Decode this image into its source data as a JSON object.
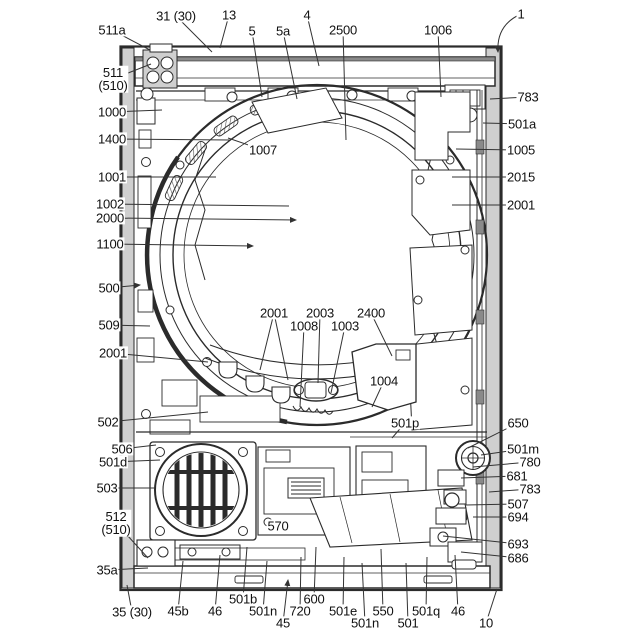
{
  "figure": {
    "kind": "patent-line-drawing",
    "colors": {
      "background": "#ffffff",
      "line": "#2b2b2b",
      "label_text": "#111111",
      "edge_gray": "#cfcfcf"
    },
    "labels": [
      {
        "t": "511a",
        "x": 112,
        "y": 30,
        "to": [
          [
            150,
            50
          ]
        ]
      },
      {
        "t": "31 (30)",
        "x": 176,
        "y": 16,
        "to": [
          [
            212,
            52
          ]
        ]
      },
      {
        "t": "13",
        "x": 229,
        "y": 15,
        "to": [
          [
            220,
            48
          ]
        ]
      },
      {
        "t": "5",
        "x": 252,
        "y": 31,
        "to": [
          [
            262,
            97
          ]
        ]
      },
      {
        "t": "5a",
        "x": 283,
        "y": 31,
        "to": [
          [
            297,
            99
          ]
        ]
      },
      {
        "t": "4",
        "x": 307,
        "y": 15,
        "to": [
          [
            319,
            66
          ]
        ]
      },
      {
        "t": "2500",
        "x": 343,
        "y": 30,
        "to": [
          [
            346,
            140
          ]
        ]
      },
      {
        "t": "1006",
        "x": 438,
        "y": 30,
        "to": [
          [
            441,
            97
          ]
        ]
      },
      {
        "t": "1",
        "x": 521,
        "y": 14,
        "to": [
          [
            498,
            52
          ]
        ],
        "arrow": true,
        "curve": true
      },
      {
        "t": "511\n(510)",
        "x": 113,
        "y": 79,
        "to": [
          [
            151,
            64
          ]
        ]
      },
      {
        "t": "1000",
        "x": 112,
        "y": 112,
        "to": [
          [
            162,
            110
          ]
        ]
      },
      {
        "t": "1400",
        "x": 112,
        "y": 139,
        "to": [
          [
            230,
            140
          ]
        ]
      },
      {
        "t": "1001",
        "x": 112,
        "y": 177,
        "to": [
          [
            216,
            177
          ]
        ]
      },
      {
        "t": "1002",
        "x": 110,
        "y": 204,
        "to": [
          [
            289,
            206
          ]
        ]
      },
      {
        "t": "2000",
        "x": 110,
        "y": 218,
        "to": [
          [
            296,
            220
          ]
        ],
        "arrow": true
      },
      {
        "t": "1100",
        "x": 110,
        "y": 244,
        "to": [
          [
            253,
            246
          ]
        ],
        "arrow": true
      },
      {
        "t": "500",
        "x": 109,
        "y": 288,
        "to": [
          [
            140,
            285
          ]
        ],
        "arrow": true
      },
      {
        "t": "509",
        "x": 109,
        "y": 325,
        "to": [
          [
            150,
            326
          ]
        ]
      },
      {
        "t": "2001",
        "x": 113,
        "y": 353,
        "to": [
          [
            208,
            362
          ]
        ]
      },
      {
        "t": "502",
        "x": 108,
        "y": 422,
        "to": [
          [
            208,
            412
          ]
        ]
      },
      {
        "t": "506",
        "x": 122,
        "y": 449,
        "to": [
          [
            156,
            445
          ]
        ]
      },
      {
        "t": "501d",
        "x": 113,
        "y": 462,
        "to": [
          [
            160,
            460
          ]
        ]
      },
      {
        "t": "503",
        "x": 107,
        "y": 488,
        "to": [
          [
            155,
            488
          ]
        ]
      },
      {
        "t": "512\n(510)",
        "x": 116,
        "y": 523,
        "to": [
          [
            148,
            558
          ]
        ]
      },
      {
        "t": "35a",
        "x": 107,
        "y": 570,
        "to": [
          [
            148,
            568
          ]
        ]
      },
      {
        "t": "35 (30)",
        "x": 132,
        "y": 612,
        "to": [
          [
            127,
            585
          ]
        ]
      },
      {
        "t": "45b",
        "x": 178,
        "y": 611,
        "to": [
          [
            183,
            561
          ]
        ]
      },
      {
        "t": "46",
        "x": 215,
        "y": 611,
        "to": [
          [
            220,
            555
          ]
        ]
      },
      {
        "t": "501b",
        "x": 243,
        "y": 599,
        "to": [
          [
            247,
            547
          ]
        ]
      },
      {
        "t": "501n",
        "x": 263,
        "y": 611,
        "to": [
          [
            267,
            561
          ]
        ]
      },
      {
        "t": "45",
        "x": 283,
        "y": 623,
        "to": [
          [
            288,
            580
          ]
        ],
        "arrow": true
      },
      {
        "t": "720",
        "x": 300,
        "y": 611,
        "to": [
          [
            301,
            557
          ]
        ]
      },
      {
        "t": "600",
        "x": 314,
        "y": 599,
        "to": [
          [
            316,
            547
          ]
        ]
      },
      {
        "t": "501e",
        "x": 343,
        "y": 611,
        "to": [
          [
            344,
            557
          ]
        ]
      },
      {
        "t": "501n",
        "x": 365,
        "y": 623,
        "to": [
          [
            362,
            563
          ]
        ]
      },
      {
        "t": "550",
        "x": 383,
        "y": 611,
        "to": [
          [
            381,
            549
          ]
        ]
      },
      {
        "t": "501",
        "x": 408,
        "y": 623,
        "to": [
          [
            406,
            563
          ]
        ]
      },
      {
        "t": "501q",
        "x": 426,
        "y": 611,
        "to": [
          [
            427,
            557
          ]
        ]
      },
      {
        "t": "46",
        "x": 458,
        "y": 611,
        "to": [
          [
            455,
            555
          ]
        ]
      },
      {
        "t": "10",
        "x": 486,
        "y": 623,
        "to": [
          [
            497,
            589
          ]
        ]
      },
      {
        "t": "783",
        "x": 528,
        "y": 97,
        "to": [
          [
            490,
            99
          ]
        ]
      },
      {
        "t": "501a",
        "x": 522,
        "y": 124,
        "to": [
          [
            483,
            123
          ]
        ]
      },
      {
        "t": "1005",
        "x": 521,
        "y": 150,
        "to": [
          [
            456,
            149
          ]
        ]
      },
      {
        "t": "2015",
        "x": 521,
        "y": 177,
        "to": [
          [
            452,
            177
          ]
        ]
      },
      {
        "t": "2001",
        "x": 521,
        "y": 205,
        "to": [
          [
            452,
            205
          ]
        ]
      },
      {
        "t": "650",
        "x": 518,
        "y": 423,
        "to": [
          [
            468,
            448
          ]
        ]
      },
      {
        "t": "501m",
        "x": 523,
        "y": 449,
        "to": [
          [
            481,
            455
          ]
        ]
      },
      {
        "t": "780",
        "x": 530,
        "y": 462,
        "to": [
          [
            473,
            467
          ]
        ]
      },
      {
        "t": "681",
        "x": 517,
        "y": 476,
        "to": [
          [
            461,
            478
          ]
        ]
      },
      {
        "t": "783",
        "x": 530,
        "y": 489,
        "to": [
          [
            489,
            492
          ]
        ]
      },
      {
        "t": "507",
        "x": 518,
        "y": 504,
        "to": [
          [
            466,
            505
          ]
        ]
      },
      {
        "t": "694",
        "x": 518,
        "y": 517,
        "to": [
          [
            473,
            517
          ]
        ]
      },
      {
        "t": "693",
        "x": 518,
        "y": 544,
        "to": [
          [
            443,
            536
          ]
        ]
      },
      {
        "t": "686",
        "x": 518,
        "y": 558,
        "to": [
          [
            461,
            552
          ]
        ]
      },
      {
        "t": "1007",
        "x": 263,
        "y": 150,
        "to": [
          [
            228,
            138
          ]
        ]
      },
      {
        "t": "2001",
        "x": 274,
        "y": 313,
        "to": [
          [
            260,
            370
          ],
          [
            288,
            380
          ]
        ]
      },
      {
        "t": "2003",
        "x": 320,
        "y": 313,
        "to": [
          [
            318,
            383
          ]
        ]
      },
      {
        "t": "1008",
        "x": 304,
        "y": 326,
        "to": [
          [
            300,
            407
          ]
        ]
      },
      {
        "t": "1003",
        "x": 345,
        "y": 326,
        "to": [
          [
            331,
            393
          ]
        ]
      },
      {
        "t": "2400",
        "x": 371,
        "y": 313,
        "to": [
          [
            392,
            356
          ]
        ]
      },
      {
        "t": "1004",
        "x": 384,
        "y": 381,
        "to": [
          [
            372,
            407
          ]
        ]
      },
      {
        "t": "501p",
        "x": 405,
        "y": 423,
        "to": [
          [
            392,
            438
          ]
        ]
      },
      {
        "t": "570",
        "x": 278,
        "y": 526,
        "to": []
      }
    ]
  }
}
